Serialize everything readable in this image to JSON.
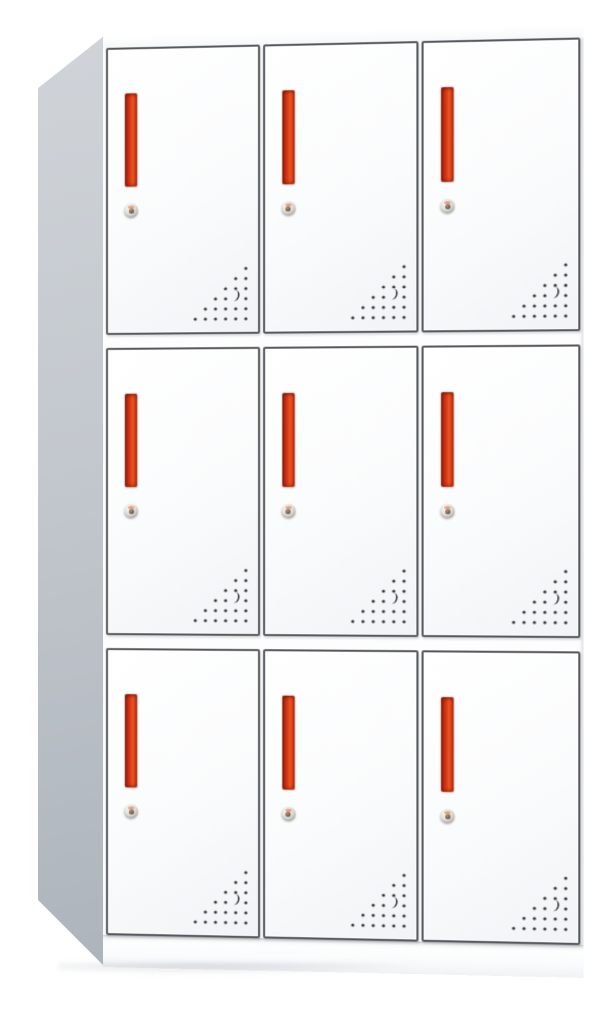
{
  "scene": {
    "type": "product-photo",
    "subject": "9-door metal office locker cabinet",
    "description": "White steel locker with 9 compartments in a 3x3 grid, photographed slightly from the left. Each door has a recessed red vertical handle, a round silver cam lock below it, and a triangular pattern of ventilation holes with a crescent-shaped cutout in the lower-right corner. Light gray side panel visible on the left, white base plinth at the bottom.",
    "background_color": "#ffffff"
  },
  "cabinet": {
    "rows": 3,
    "columns": 3,
    "door_count": 9,
    "handle_count": 9,
    "lock_count": 9,
    "vent_count": 9,
    "colors": {
      "body_white": "#fdfdfe",
      "door_face_top": "#ffffff",
      "door_face_bottom": "#f1f3f6",
      "door_border": "#55585c",
      "side_top": "#d0d4d9",
      "side_bottom": "#aeb4bc",
      "handle_main": "#df3d14",
      "handle_dark": "#8e2012",
      "handle_light": "#ea5420",
      "lock_silver": "#dcdbd6",
      "vent_dot": "#3c3c3c",
      "plinth": "#fafbfc"
    },
    "vent_pattern": {
      "shape": "right-triangle of drilled dots, right-angle at bottom-right",
      "rows": 6,
      "spacing": 10,
      "dot_radius": 1.6,
      "crescent": {
        "row_from_top": 4,
        "col_from_right": 2
      }
    }
  },
  "doors": [
    {
      "id": "door-r1-c1",
      "row": 1,
      "col": 1
    },
    {
      "id": "door-r1-c2",
      "row": 1,
      "col": 2
    },
    {
      "id": "door-r1-c3",
      "row": 1,
      "col": 3
    },
    {
      "id": "door-r2-c1",
      "row": 2,
      "col": 1
    },
    {
      "id": "door-r2-c2",
      "row": 2,
      "col": 2
    },
    {
      "id": "door-r2-c3",
      "row": 2,
      "col": 3
    },
    {
      "id": "door-r3-c1",
      "row": 3,
      "col": 1
    },
    {
      "id": "door-r3-c2",
      "row": 3,
      "col": 2
    },
    {
      "id": "door-r3-c3",
      "row": 3,
      "col": 3
    }
  ]
}
